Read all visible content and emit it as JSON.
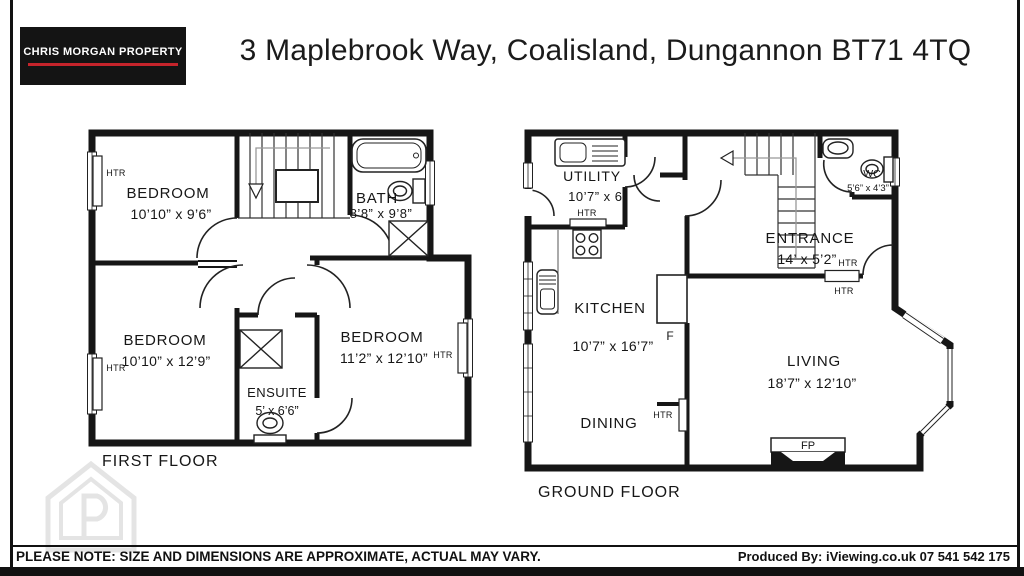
{
  "header": {
    "logo": "CHRIS MORGAN PROPERTY",
    "title": "3 Maplebrook Way, Coalisland, Dungannon BT71 4TQ"
  },
  "first_floor": {
    "label": "FIRST FLOOR",
    "bedroom1": {
      "name": "BEDROOM",
      "dims": "10’10” x 9’6”"
    },
    "bath": {
      "name": "BATH",
      "dims": "8’8” x 9’8”"
    },
    "bedroom2": {
      "name": "BEDROOM",
      "dims": "10’10” x 12’9”"
    },
    "bedroom3": {
      "name": "BEDROOM",
      "dims": "11’2” x 12’10”"
    },
    "ensuite": {
      "name": "ENSUITE",
      "dims": "5’ x 6’6”"
    }
  },
  "ground_floor": {
    "label": "GROUND FLOOR",
    "utility": {
      "name": "UTILITY",
      "dims": "10’7” x 6’"
    },
    "wc": {
      "name": "WC",
      "dims": "5’6” x 4’3”"
    },
    "entrance": {
      "name": "ENTRANCE",
      "dims": "14’ x 5’2”"
    },
    "kitchen": {
      "name": "KITCHEN",
      "dims": "10’7” x 16’7”"
    },
    "dining": {
      "name": "DINING"
    },
    "living": {
      "name": "LIVING",
      "dims": "18’7” x 12’10”"
    },
    "fridge_label": "F",
    "fireplace_label": "FP"
  },
  "annotations": {
    "heater": "HTR"
  },
  "footer": {
    "note": "PLEASE NOTE: SIZE AND DIMENSIONS ARE APPROXIMATE, ACTUAL MAY VARY.",
    "produced_by": "Produced By: iViewing.co.uk 07 541 542 175"
  },
  "colors": {
    "wall": "#161616",
    "logo_bg": "#141414",
    "logo_accent": "#c5242b",
    "watermark": "#e4e4e4"
  }
}
